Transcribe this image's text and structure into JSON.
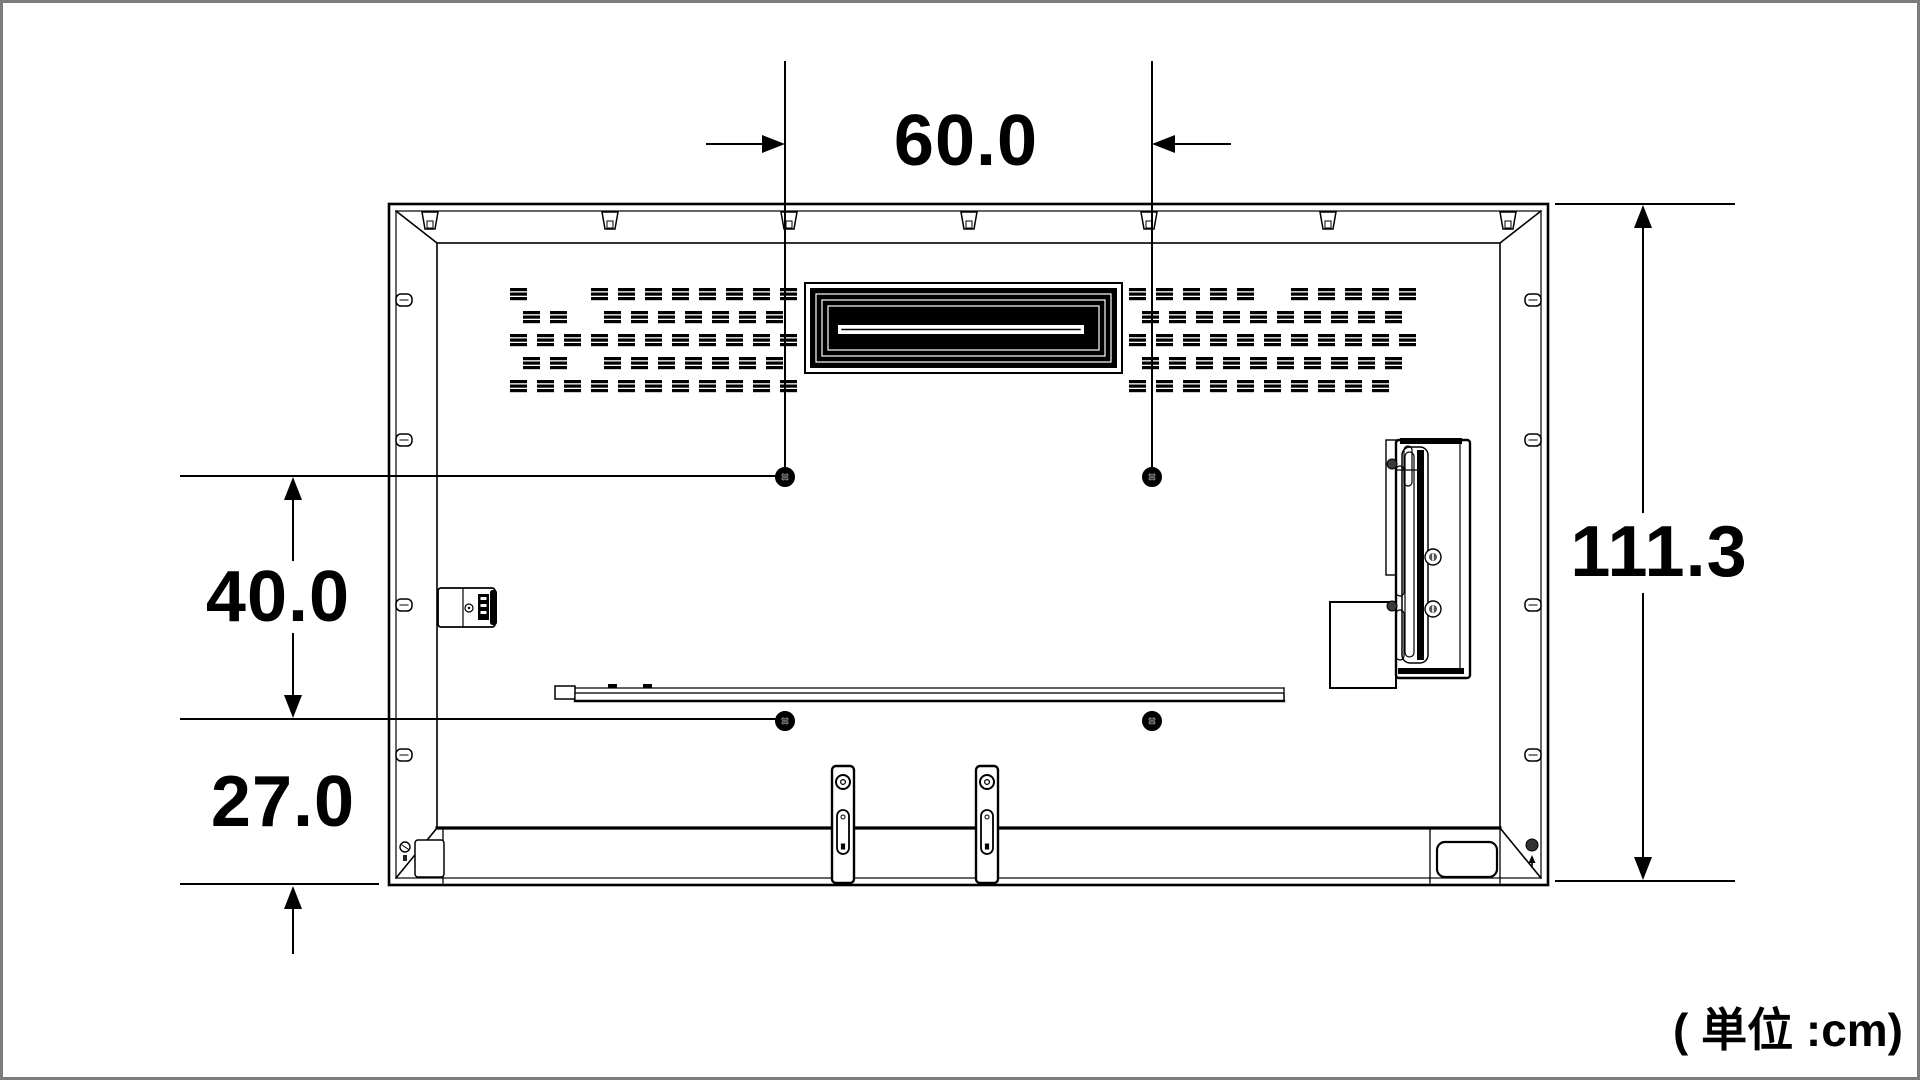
{
  "dimensions": {
    "mount_width": "60.0",
    "mount_height": "40.0",
    "mount_bottom_offset": "27.0",
    "set_height": "111.3"
  },
  "unit_note": "( 単位 :cm)",
  "colors": {
    "line": "#000000",
    "background": "#ffffff",
    "frame_border": "#7d7d7d"
  }
}
